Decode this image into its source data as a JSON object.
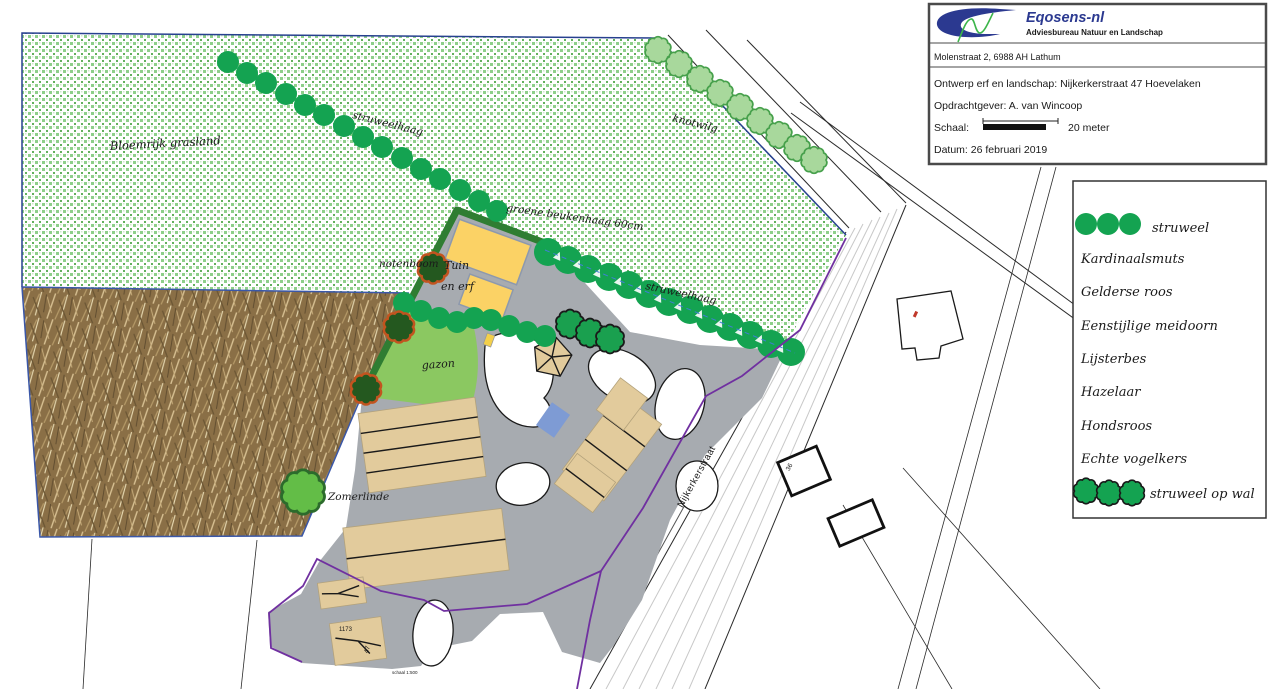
{
  "title_block": {
    "brand": "Eqosens-nl",
    "brand_subtitle": "Adviesbureau Natuur en Landschap",
    "address": "Molenstraat 2,  6988 AH Lathum",
    "project_title": "Ontwerp erf en landschap: Nijkerkerstraat 47 Hoevelaken",
    "client": "Opdrachtgever: A. van Wincoop",
    "scale_label": "Schaal:",
    "scale_value": "20 meter",
    "date": "Datum: 26 februari 2019"
  },
  "legend": {
    "items": [
      {
        "icon": "struweel-icon",
        "label": "struweel"
      },
      {
        "label": "Kardinaalsmuts"
      },
      {
        "label": "Gelderse roos"
      },
      {
        "label": "Eenstijlige meidoorn"
      },
      {
        "label": "Lijsterbes"
      },
      {
        "label": "Hazelaar"
      },
      {
        "label": "Hondsroos"
      },
      {
        "label": "Echte vogelkers"
      },
      {
        "icon": "struweel-op-wal-icon",
        "label": "struweel op wal"
      }
    ]
  },
  "map": {
    "labels": {
      "grassland": "Bloemrijk grasland",
      "hedgerow_top": "struweelhaag",
      "hedgerow_mid": "struweelhaag",
      "pollard_willows": "knotwilg",
      "beech_hedge": "groene beukenhaag 60cm",
      "walnut_tree": "notenboom",
      "garden_line1": "Tuin",
      "garden_line2": "en erf",
      "lawn": "gazon",
      "summer_lime": "Zomerlinde",
      "road_name": "Nijkerkerstraat",
      "parcel_number": "1173",
      "house_number_main": "47",
      "house_number_across": "36",
      "fine_print": "schaal 1:500"
    }
  },
  "colors": {
    "struweel_green": "#14a351",
    "knotwilg_fill": "#a8d89c",
    "knotwilg_stroke": "#46a04b",
    "grass_pattern_green": "#8ecf8a",
    "lawn_green": "#8bc861",
    "hedge_green": "#2f7d32",
    "walnut_fill": "#24581f",
    "walnut_stroke": "#c2541f",
    "paving_gray": "#a7abb0",
    "building_yellow": "#fbd265",
    "building_tan": "#e2cb9c",
    "water_blue": "#7e9bd4",
    "boundary_purple": "#7030a0",
    "boundary_blue": "#27418f",
    "logo_blue": "#2b3990",
    "logo_green": "#3cb54a",
    "number_red": "#c0392b"
  }
}
